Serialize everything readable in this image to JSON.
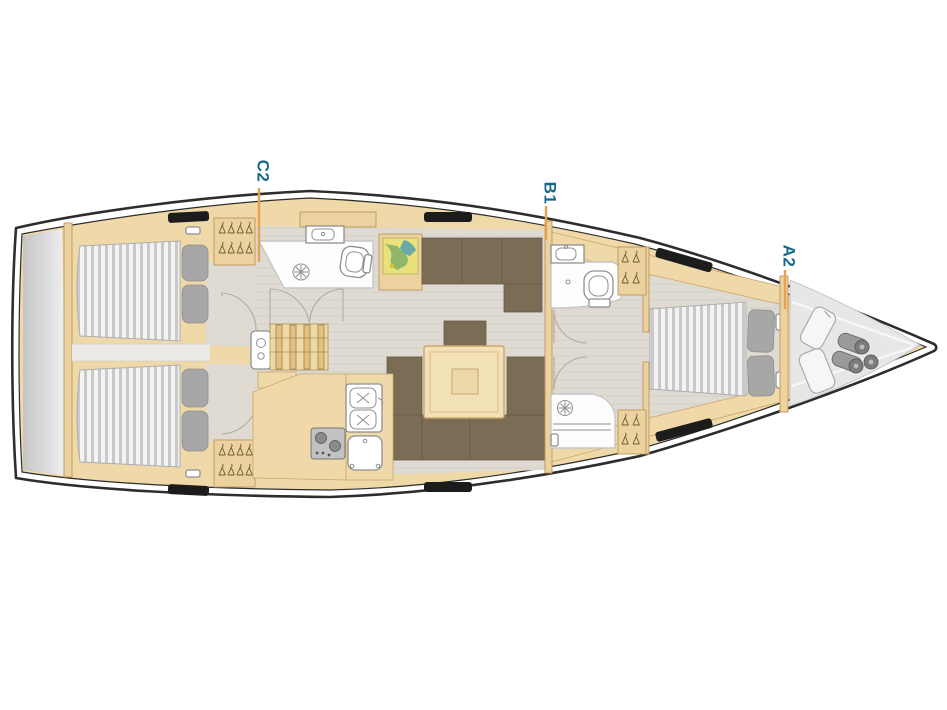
{
  "diagram": {
    "kind": "sailing-yacht-interior-deck-plan",
    "orientation": "bow-right",
    "cabin_labels": [
      {
        "id": "c2",
        "text": "C2"
      },
      {
        "id": "b1",
        "text": "B1"
      },
      {
        "id": "a2",
        "text": "A2"
      }
    ],
    "icons": [
      "double-bed",
      "pillow",
      "wardrobe-hangers",
      "toilet",
      "washbasin",
      "shower-drain",
      "companionway-steps",
      "galley-sink",
      "stove",
      "fridge",
      "chart-table-map",
      "salon-table",
      "settee",
      "sail-bags",
      "fenders"
    ],
    "colors": {
      "label_text": "#17698c",
      "leader_line": "#e8a24d",
      "hull_stroke": "#2d2d2d",
      "deck_wood": "#f0d9a9",
      "wood_trim": "#ecd29e",
      "wood_border": "#bb965e",
      "floor": "#dfdbd3",
      "floor_light": "#eceae6",
      "upholstery": "#7b6c55",
      "upholstery_dark": "#675a46",
      "mattress_stripe": "#c9c9c9",
      "pillow": "#a7a7a7",
      "white_room": "#fdfdfd",
      "room_stroke": "#c6c6c6",
      "fixture_stroke": "#8f8f8f",
      "transom_dark": "#c5c5c5",
      "transom_light": "#f2f2f2",
      "locker_gray": "#e7e7e7",
      "map_base": "#e9e27b",
      "map_green": "#86b169",
      "map_teal": "#52a0af",
      "deck_fitting": "#1c1c1c",
      "arc_stroke": "#b3ab9d"
    }
  }
}
